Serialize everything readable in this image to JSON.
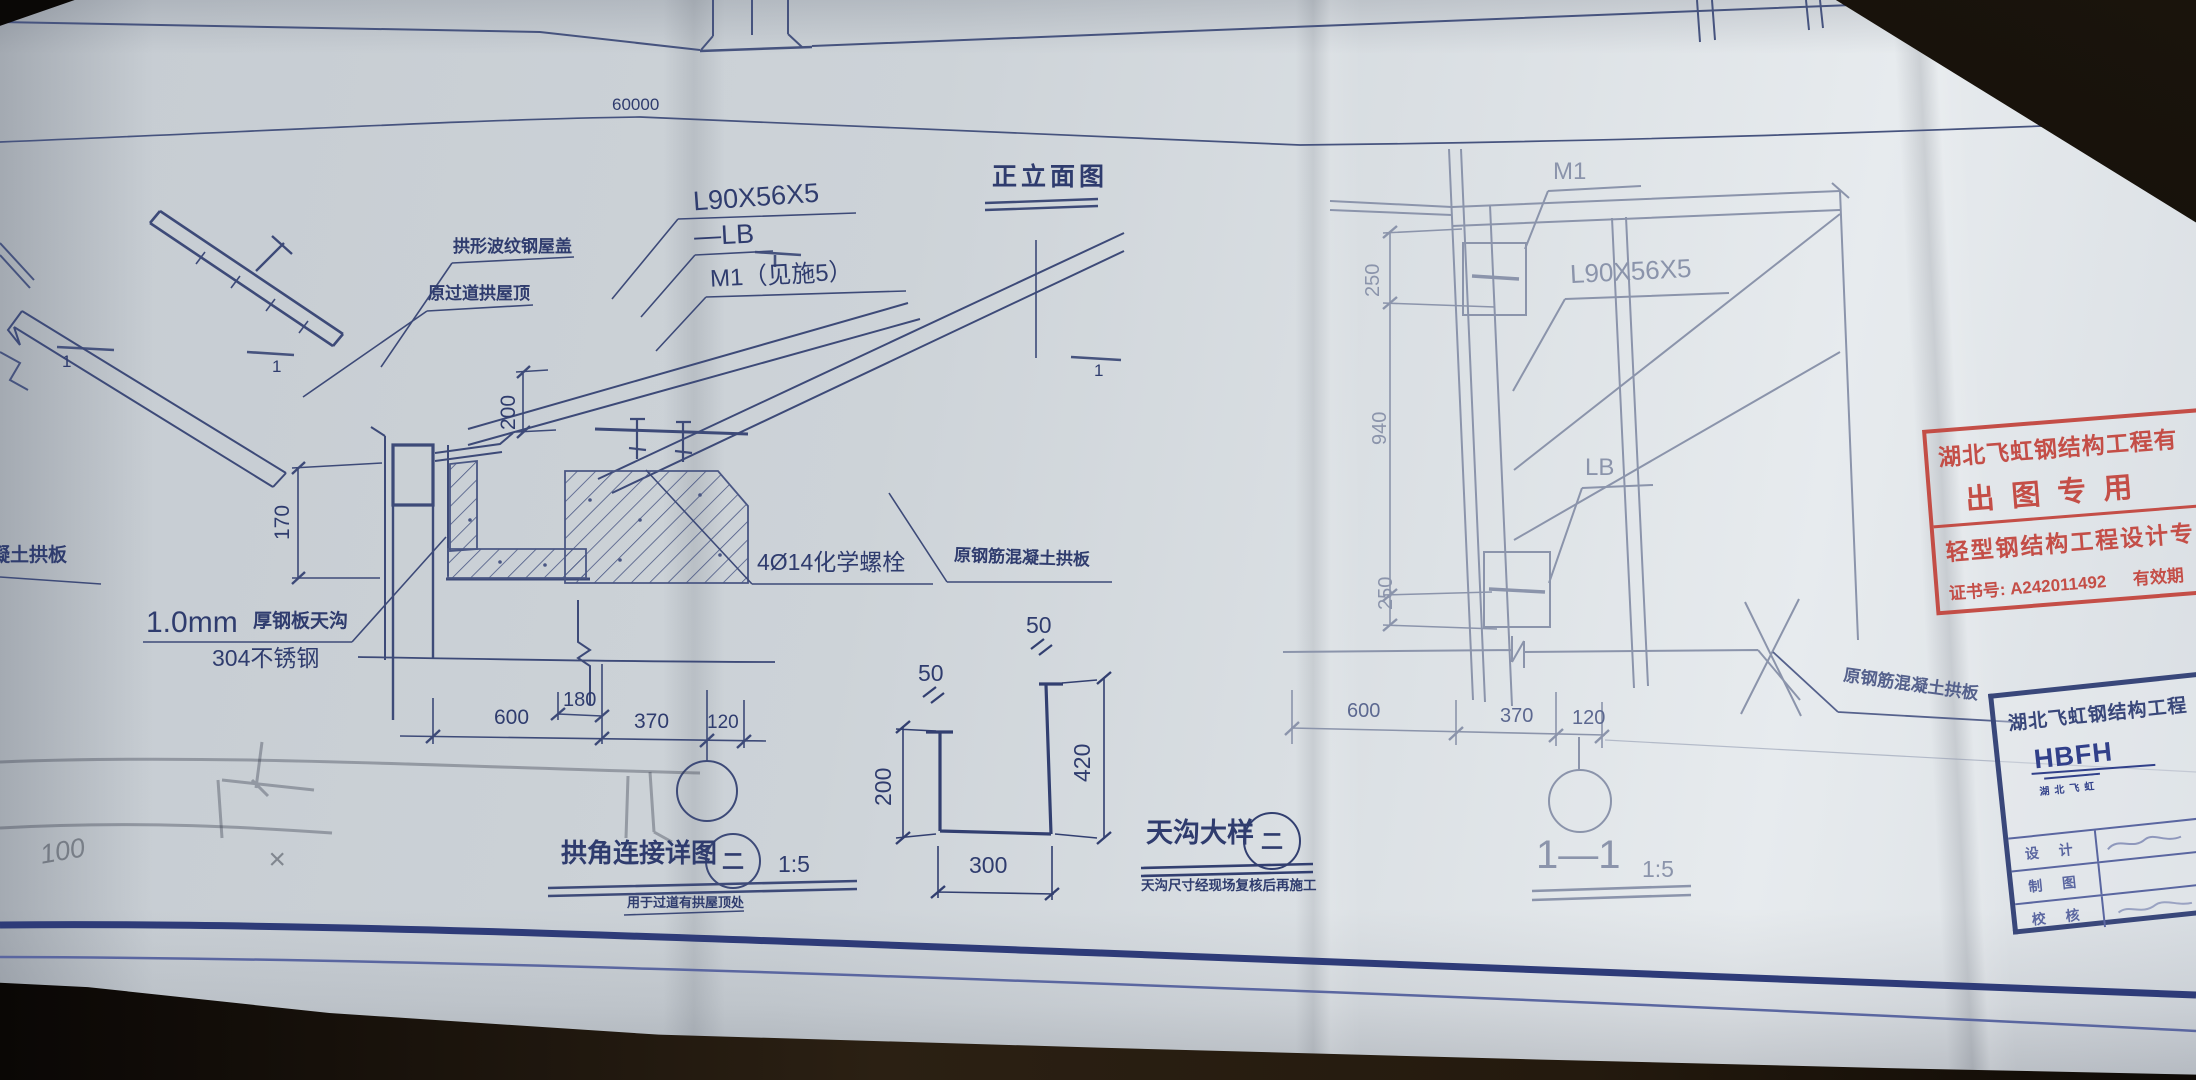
{
  "drawing": {
    "overall_dim": "60000",
    "elevation_title": "正立面图",
    "section_mark": "1",
    "left_edge_label": "混凝土拱板",
    "corner": {
      "labels": {
        "roof_cover": "拱形波纹钢屋盖",
        "old_roof": "原过道拱屋顶",
        "angle": "L90X56X5",
        "lb": "—LB",
        "m1": "M1（见施5）",
        "bolts": "4Ø14化学螺栓",
        "slab": "原钢筋混凝土拱板",
        "gutter_mm": "1.0mm",
        "gutter_txt": "厚钢板天沟",
        "gutter_steel": "304不锈钢"
      },
      "dims": {
        "h200": "200",
        "h170": "170",
        "w180": "180",
        "w600": "600",
        "w370": "370",
        "w120": "120"
      },
      "title": "拱角连接详图",
      "title_num": "二",
      "scale": "1:5",
      "note": "用于过道有拱屋顶处"
    },
    "gutter": {
      "title": "天沟大样",
      "title_num": "二",
      "note": "天沟尺寸经现场复核后再施工",
      "dims": {
        "flange_left": "50",
        "flange_right": "50",
        "h200": "200",
        "h420": "420",
        "w300": "300"
      }
    },
    "section": {
      "title": "1—1",
      "scale": "1:5",
      "labels": {
        "m1": "M1",
        "angle": "L90X56X5",
        "lb": "LB",
        "slab": "原钢筋混凝土拱板"
      },
      "dims": {
        "t250": "250",
        "m940": "940",
        "b250": "250",
        "w600": "600",
        "w370": "370",
        "w120": "120"
      }
    }
  },
  "stamp": {
    "line1": "湖北飞虹钢结构工程有",
    "line2": "出图专用",
    "line3": "轻型钢结构工程设计专",
    "cert": "证书号: A242011492",
    "cert_suffix": "有效期"
  },
  "title_block": {
    "company": "湖北飞虹钢结构工程",
    "logo": "HBFH",
    "logo_sub": "湖北飞虹",
    "rows": [
      {
        "label": "设 计"
      },
      {
        "label": "制 图"
      },
      {
        "label": "校 核"
      }
    ]
  },
  "pencil": {
    "dim": "100",
    "mark": "×"
  }
}
